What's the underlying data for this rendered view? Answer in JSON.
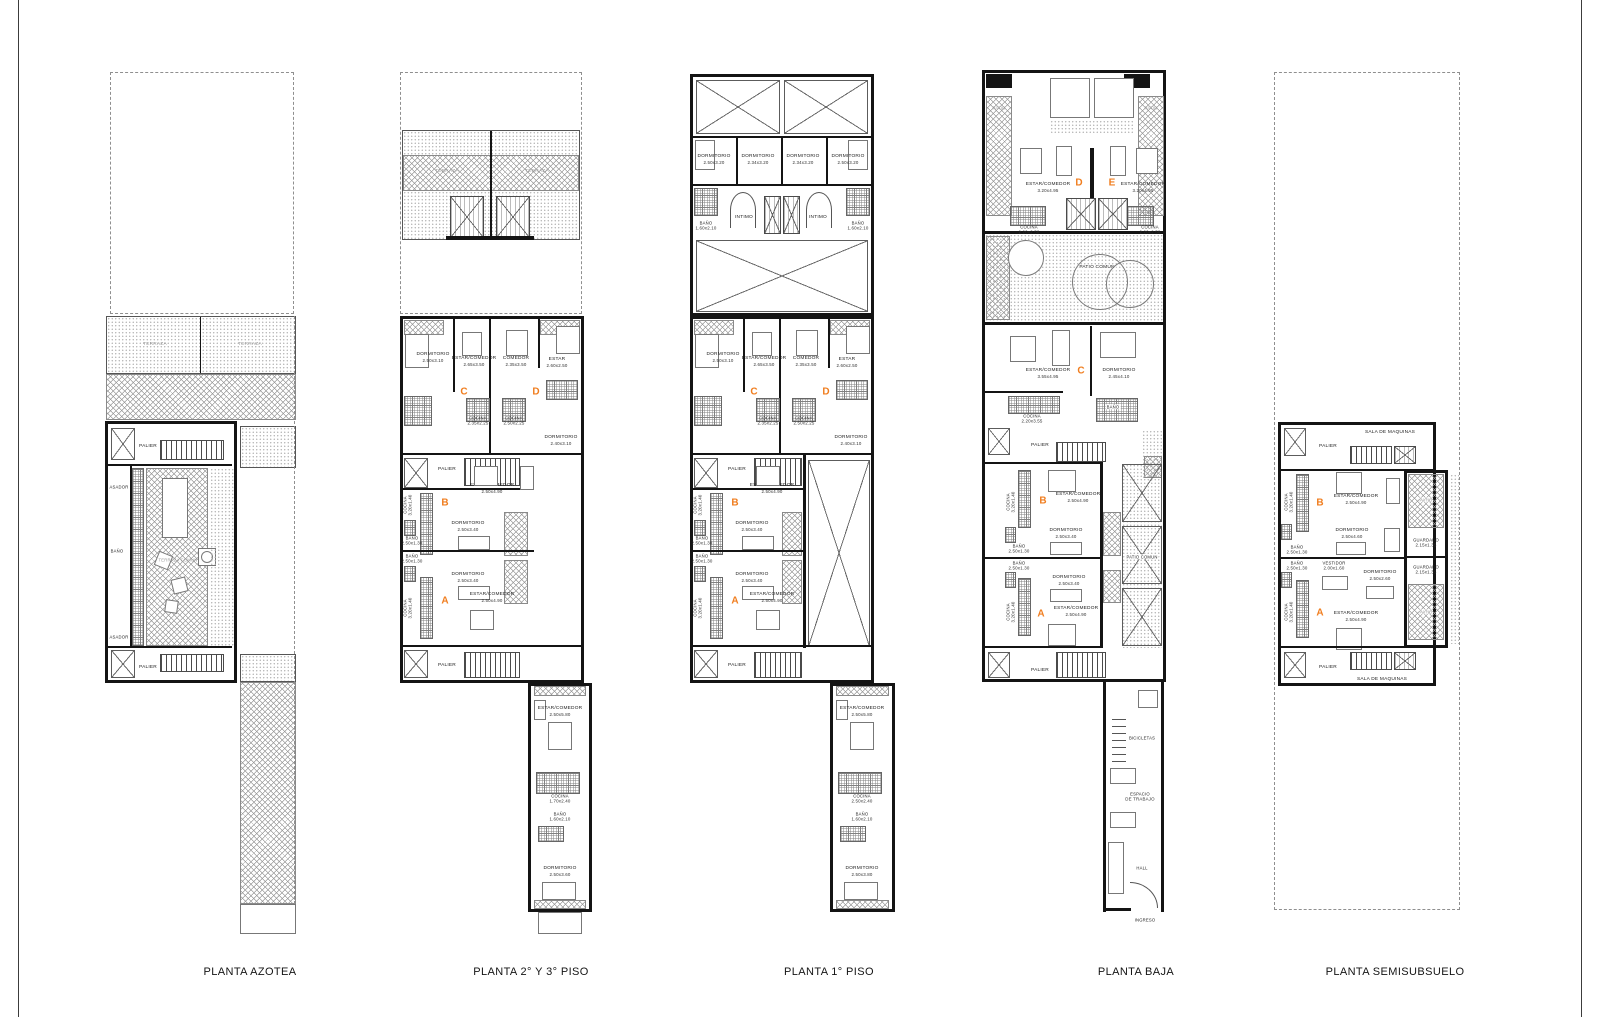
{
  "colors": {
    "unit_letter": "#f07d1e",
    "wall": "#141414",
    "hatch": "#9a9a9a"
  },
  "az": {
    "title": "PLANTA AZOTEA",
    "terraza_l": "TERRAZA",
    "terraza_r": "TERRAZA",
    "palier_top": "PALIER",
    "palier_bot": "PALIER",
    "asador_top": "ASADOR",
    "asador_bot": "ASADOR",
    "banio": "BAÑO",
    "terraza_comun": "TERRAZA COMUN"
  },
  "p23": {
    "title": "PLANTA 2° Y 3°  PISO",
    "terraza_l": "TERRAZA",
    "terraza_r": "TERRAZA",
    "unit_a": "A",
    "unit_b": "B",
    "unit_c": "C",
    "unit_d": "D",
    "dorm_c": {
      "n": "DORMITORIO",
      "d": "2.50x3.10"
    },
    "estar_c": {
      "n": "ESTAR/COMEDOR",
      "d": "2.65x3.50"
    },
    "comedor_d": {
      "n": "COMEDOR",
      "d": "2.35x3.50"
    },
    "estar_d": {
      "n": "ESTAR",
      "d": "2.60x2.50"
    },
    "cocina_c": {
      "n": "COCINA",
      "d": "2.35x2.25"
    },
    "cocina_d": {
      "n": "COCINA",
      "d": "2.50x2.25"
    },
    "dorm_d": {
      "n": "DORMITORIO",
      "d": "2.40x3.10"
    },
    "palier_mid": "PALIER",
    "palier_bot": "PALIER",
    "estar_b": {
      "n": "ESTAR/COMEDOR",
      "d": "2.50x4.90"
    },
    "dorm_b": {
      "n": "DORMITORIO",
      "d": "2.50x3.40"
    },
    "banio_b": {
      "n": "BAÑO",
      "d": "2.50x1.30"
    },
    "banio_a": {
      "n": "BAÑO",
      "d": "2.50x1.30"
    },
    "dorm_a": {
      "n": "DORMITORIO",
      "d": "2.50x3.40"
    },
    "estar_a": {
      "n": "ESTAR/COMEDOR",
      "d": "2.50x4.90"
    },
    "cocina_b": {
      "n": "COCINA",
      "d": "3.20x1.40"
    },
    "cocina_a": {
      "n": "COCINA",
      "d": "3.20x1.40"
    },
    "ext_estar": {
      "n": "ESTAR/COMEDOR",
      "d": "2.50x5.80"
    },
    "ext_cocina": {
      "n": "COCINA",
      "d": "1.70x2.40"
    },
    "ext_banio": {
      "n": "BAÑO",
      "d": "1.60x2.10"
    },
    "ext_dorm": {
      "n": "DORMITORIO",
      "d": "2.50x3.60"
    }
  },
  "p1": {
    "title": "PLANTA 1° PISO",
    "dorm1": {
      "n": "DORMITORIO",
      "d": "2.50x3.20"
    },
    "dorm2": {
      "n": "DORMITORIO",
      "d": "2.34x3.20"
    },
    "dorm3": {
      "n": "DORMITORIO",
      "d": "2.34x3.20"
    },
    "dorm4": {
      "n": "DORMITORIO",
      "d": "2.50x3.20"
    },
    "banio_l": {
      "n": "BAÑO",
      "d": "1.60x2.10"
    },
    "banio_r": {
      "n": "BAÑO",
      "d": "1.60x2.10"
    },
    "intimo_l": "INTIMO",
    "intimo_r": "INTIMO",
    "unit_a": "A",
    "unit_b": "B",
    "unit_c": "C",
    "unit_d": "D",
    "dorm_c": {
      "n": "DORMITORIO",
      "d": "2.50x3.10"
    },
    "estar_c": {
      "n": "ESTAR/COMEDOR",
      "d": "2.65x3.50"
    },
    "comedor_d": {
      "n": "COMEDOR",
      "d": "2.35x3.50"
    },
    "estar_d": {
      "n": "ESTAR",
      "d": "2.60x2.50"
    },
    "cocina_c": {
      "n": "COCINA",
      "d": "2.35x2.25"
    },
    "cocina_d": {
      "n": "COCINA",
      "d": "2.50x2.25"
    },
    "dorm_d": {
      "n": "DORMITORIO",
      "d": "2.40x3.10"
    },
    "palier_mid": "PALIER",
    "palier_bot": "PALIER",
    "estar_b": {
      "n": "ESTAR/COMEDOR",
      "d": "2.50x4.90"
    },
    "dorm_b": {
      "n": "DORMITORIO",
      "d": "2.50x3.40"
    },
    "banio_b": {
      "n": "BAÑO",
      "d": "2.50x1.30"
    },
    "banio_a": {
      "n": "BAÑO",
      "d": "2.50x1.30"
    },
    "dorm_a": {
      "n": "DORMITORIO",
      "d": "2.50x3.40"
    },
    "estar_a": {
      "n": "ESTAR/COMEDOR",
      "d": "2.50x4.90"
    },
    "cocina_b": {
      "n": "COCINA",
      "d": "3.20x1.40"
    },
    "cocina_a": {
      "n": "COCINA",
      "d": "3.20x1.40"
    },
    "ext_estar": {
      "n": "ESTAR/COMEDOR",
      "d": "2.50x5.80"
    },
    "ext_cocina": {
      "n": "COCINA",
      "d": "2.50x2.40"
    },
    "ext_banio": {
      "n": "BAÑO",
      "d": "1.60x2.10"
    },
    "ext_dorm": {
      "n": "DORMITORIO",
      "d": "2.50x3.80"
    }
  },
  "pb": {
    "title": "PLANTA BAJA",
    "unit_a": "A",
    "unit_b": "B",
    "unit_c": "C",
    "unit_d": "D",
    "unit_e": "E",
    "patio_l": "PATIO",
    "patio_r": "PATIO",
    "estar_d": {
      "n": "ESTAR/COMEDOR",
      "d": "3.20x4.95"
    },
    "estar_e": {
      "n": "ESTAR/COMEDOR",
      "d": "3.20x4.95"
    },
    "cocina_d": {
      "n": "COCINA",
      "d": "2.20x2.50"
    },
    "cocina_e": {
      "n": "COCINA",
      "d": "2.20x2.50"
    },
    "patio_comun_top": "PATIO COMUN",
    "estar_c": {
      "n": "ESTAR/COMEDOR",
      "d": "3.55x4.95"
    },
    "dorm_c": {
      "n": "DORMITORIO",
      "d": "2.45x4.10"
    },
    "cocina_c": {
      "n": "COCINA",
      "d": "2.20x3.55"
    },
    "banio_c": "BAÑO",
    "palier_mid": "PALIER",
    "palier_bot": "PALIER",
    "estar_b": {
      "n": "ESTAR/COMEDOR",
      "d": "2.50x4.90"
    },
    "dorm_b": {
      "n": "DORMITORIO",
      "d": "2.50x3.40"
    },
    "banio_b": {
      "n": "BAÑO",
      "d": "2.50x1.30"
    },
    "banio_a": {
      "n": "BAÑO",
      "d": "2.50x1.30"
    },
    "dorm_a": {
      "n": "DORMITORIO",
      "d": "2.50x3.40"
    },
    "estar_a": {
      "n": "ESTAR/COMEDOR",
      "d": "2.50x4.90"
    },
    "cocina_b": {
      "n": "COCINA",
      "d": "3.20x1.40"
    },
    "cocina_a": {
      "n": "COCINA",
      "d": "3.20x1.40"
    },
    "patio_comun_side": "PATIO COMUN",
    "bicicletas": "BICICLETAS",
    "espacio": {
      "n": "ESPACIO",
      "d": "DE TRABAJO"
    },
    "hall": "HALL",
    "ingreso": "INGRESO"
  },
  "ps": {
    "title": "PLANTA SEMISUBSUELO",
    "sala_top": "SALA DE MAQUINAS",
    "sala_bot": "SALA DE MAQUINAS",
    "palier_top": "PALIER",
    "palier_bot": "PALIER",
    "unit_a": "A",
    "unit_b": "B",
    "estar_b": {
      "n": "ESTAR/COMEDOR",
      "d": "2.50x4.90"
    },
    "dorm_b": {
      "n": "DORMITORIO",
      "d": "2.50x4.60"
    },
    "patio_t": "PATIO",
    "patio_b": "PATIO",
    "guardado1": {
      "n": "GUARDADO",
      "d": "2.15x1.35"
    },
    "guardado2": {
      "n": "GUARDADO",
      "d": "2.15x1.35"
    },
    "banio_b": {
      "n": "BAÑO",
      "d": "2.50x1.30"
    },
    "banio_a": {
      "n": "BAÑO",
      "d": "2.50x1.30"
    },
    "vestidor": {
      "n": "VESTIDOR",
      "d": "2.00x1.60"
    },
    "dorm_a": {
      "n": "DORMITORIO",
      "d": "2.50x2.60"
    },
    "cocina_b": {
      "n": "COCINA",
      "d": "3.20x1.40"
    },
    "cocina_a": {
      "n": "COCINA",
      "d": "3.20x1.40"
    },
    "estar_a": {
      "n": "ESTAR/COMEDOR",
      "d": "2.50x4.90"
    }
  }
}
